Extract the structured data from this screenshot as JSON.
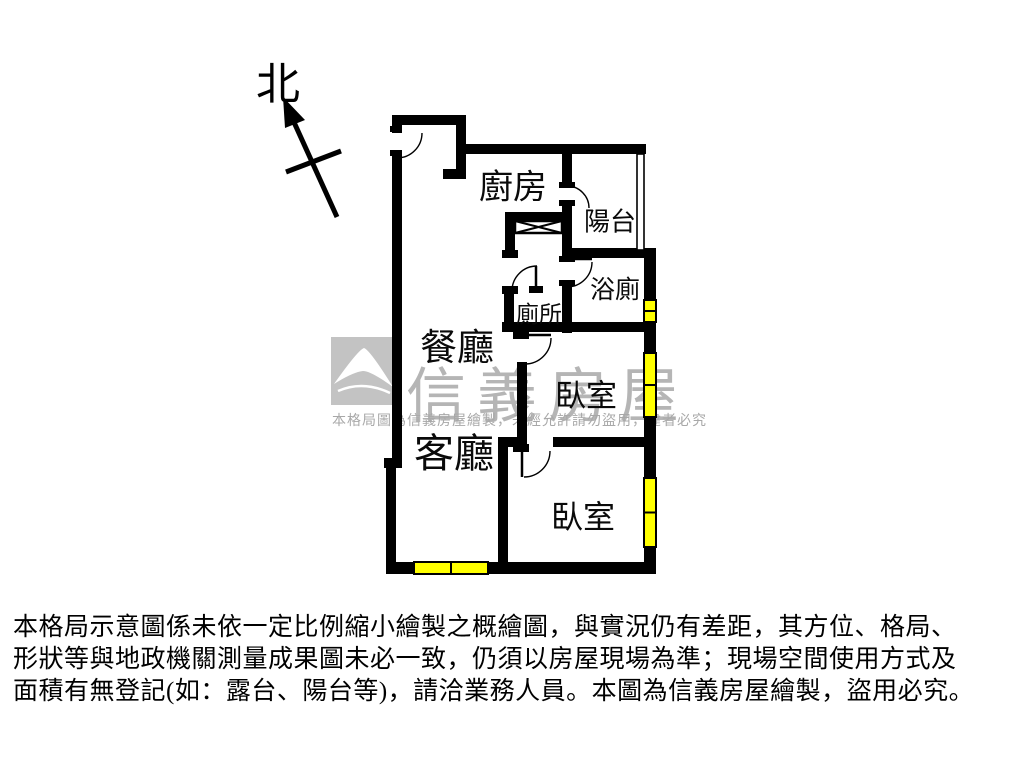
{
  "compass": {
    "label": "北"
  },
  "rooms": [
    {
      "id": "kitchen",
      "label": "廚房",
      "x": 513,
      "y": 184,
      "size": 34
    },
    {
      "id": "balcony",
      "label": "陽台",
      "x": 610,
      "y": 220,
      "size": 26
    },
    {
      "id": "bathroom",
      "label": "浴廁",
      "x": 615,
      "y": 288,
      "size": 25
    },
    {
      "id": "toilet",
      "label": "廁所",
      "x": 539,
      "y": 312,
      "size": 23
    },
    {
      "id": "dining-room",
      "label": "餐廳",
      "x": 457,
      "y": 344,
      "size": 37
    },
    {
      "id": "bedroom-1",
      "label": "臥室",
      "x": 586,
      "y": 393,
      "size": 31
    },
    {
      "id": "living-room",
      "label": "客廳",
      "x": 454,
      "y": 450,
      "size": 40
    },
    {
      "id": "bedroom-2",
      "label": "臥室",
      "x": 583,
      "y": 515,
      "size": 32
    }
  ],
  "watermark": {
    "brand": "信義房屋",
    "notice": "本格局圖為信義房屋繪製，未經允許請勿盜用，違者必究",
    "logo_color": "#c3c3c3",
    "text_color": "#b5b5b5"
  },
  "disclaimer": {
    "lines": [
      "本格局示意圖係未依一定比例縮小繪製之概繪圖，與實況仍有差距，其方位、格局、",
      "形狀等與地政機關測量成果圖未必一致，仍須以房屋現場為準；現場空間使用方式及",
      "面積有無登記(如：露台、陽台等)，請洽業務人員。本圖為信義房屋繪製，盜用必究。"
    ]
  },
  "colors": {
    "wall": "#000000",
    "window": "#ffff00",
    "background": "#ffffff"
  },
  "plan": {
    "walls": [
      [
        392,
        115,
        74,
        10
      ],
      [
        456,
        115,
        10,
        64
      ],
      [
        443,
        169,
        23,
        10
      ],
      [
        392,
        125,
        10,
        8
      ],
      [
        392,
        156,
        10,
        308
      ],
      [
        384,
        458,
        18,
        10
      ],
      [
        386,
        464,
        10,
        108
      ],
      [
        386,
        562,
        28,
        12
      ],
      [
        488,
        562,
        168,
        12
      ],
      [
        456,
        144,
        190,
        10
      ],
      [
        562,
        144,
        10,
        44
      ],
      [
        562,
        206,
        10,
        56
      ],
      [
        562,
        286,
        10,
        47
      ],
      [
        562,
        248,
        94,
        10
      ],
      [
        644,
        248,
        12,
        54
      ],
      [
        644,
        320,
        12,
        14
      ],
      [
        502,
        322,
        154,
        10
      ],
      [
        644,
        332,
        12,
        23
      ],
      [
        644,
        415,
        12,
        27
      ],
      [
        505,
        212,
        67,
        9
      ],
      [
        505,
        212,
        10,
        46
      ],
      [
        502,
        250,
        16,
        8
      ],
      [
        502,
        286,
        16,
        8
      ],
      [
        504,
        290,
        10,
        34
      ],
      [
        517,
        362,
        10,
        85
      ],
      [
        498,
        437,
        29,
        10
      ],
      [
        553,
        437,
        103,
        10
      ],
      [
        498,
        447,
        10,
        117
      ],
      [
        644,
        440,
        12,
        40
      ],
      [
        644,
        545,
        12,
        29
      ]
    ],
    "hinges": [
      [
        390,
        126,
        12,
        6
      ],
      [
        390,
        150,
        12,
        6
      ],
      [
        559,
        182,
        16,
        6
      ],
      [
        559,
        200,
        16,
        6
      ],
      [
        559,
        256,
        16,
        6
      ],
      [
        559,
        280,
        16,
        6
      ],
      [
        529,
        286,
        14,
        7
      ],
      [
        513,
        331,
        16,
        8
      ],
      [
        513,
        444,
        16,
        8
      ]
    ],
    "windows": [
      {
        "x": 414,
        "y": 562,
        "w": 74,
        "h": 12,
        "orient": "h"
      },
      {
        "x": 644,
        "y": 300,
        "w": 12,
        "h": 22,
        "orient": "v"
      },
      {
        "x": 644,
        "y": 353,
        "w": 12,
        "h": 64,
        "orient": "v"
      },
      {
        "x": 644,
        "y": 478,
        "w": 12,
        "h": 69,
        "orient": "v"
      }
    ],
    "railing": {
      "x": 637,
      "y": 154,
      "w": 7,
      "h": 96
    },
    "xbox": {
      "x": 515,
      "y": 221,
      "w": 47,
      "h": 12
    },
    "doors": [
      {
        "arc": "M 422,133 A 25,25 0 0 1 397,158",
        "leaf": null
      },
      {
        "arc": "M 567,186 A 22,22 0 0 1 589,208",
        "leaf": null
      },
      {
        "arc": "M 592,262 A 25,25 0 0 1 567,287",
        "leaf": [
          567,
          259,
          592,
          259
        ]
      },
      {
        "arc": "M 537,266 A 25,25 0 0 0 512,291",
        "leaf": [
          536,
          266,
          536,
          291
        ]
      },
      {
        "arc": "M 551,338 A 26,26 0 0 1 525,364",
        "leaf": [
          525,
          335,
          551,
          335
        ]
      },
      {
        "arc": "M 550,451 A 26,26 0 0 1 524,477",
        "leaf": [
          522,
          451,
          522,
          477
        ]
      }
    ],
    "north_arrow": {
      "line": [
        337,
        217,
        293,
        120
      ],
      "cross": [
        286,
        172,
        341,
        151
      ],
      "head": "283,97 305,120 285,128"
    }
  }
}
